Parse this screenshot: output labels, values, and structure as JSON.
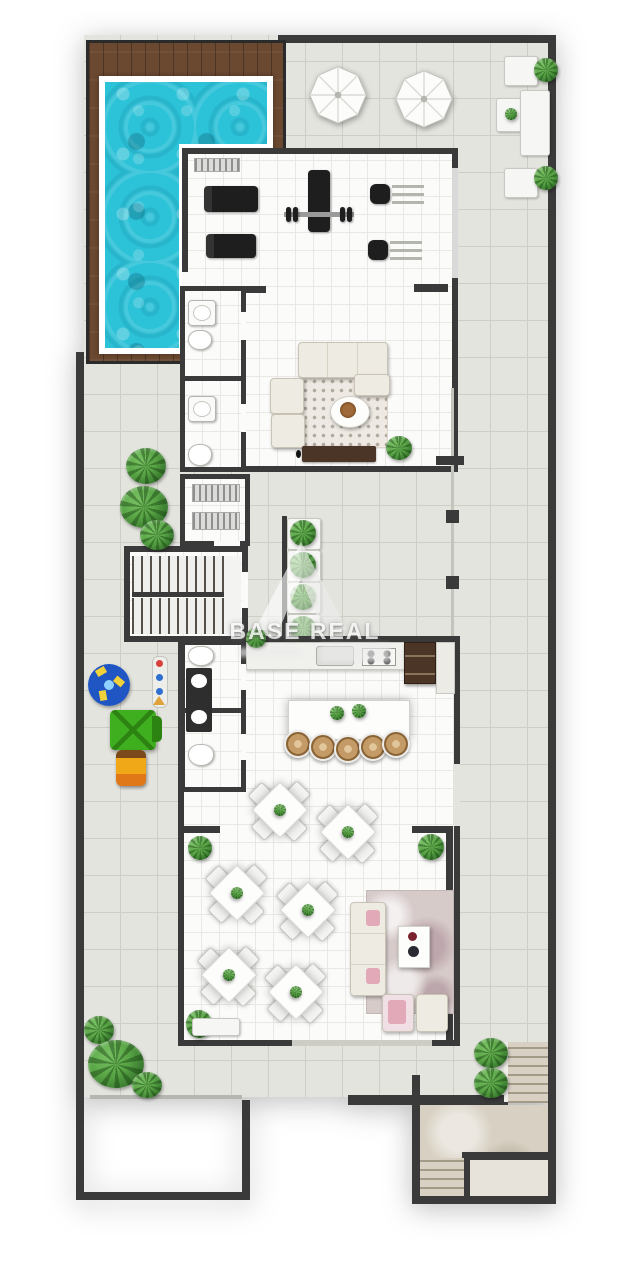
{
  "watermark": {
    "brand": "BASE REAL"
  },
  "colors": {
    "wall": "#3a3a3a",
    "deckA": "#6b4830",
    "deckB": "#54351f",
    "water": "#2cc2d8",
    "waterHi": "#7fe2ef",
    "terrace": "#e4e4df",
    "terraceLine": "#cecec6",
    "indoor": "#fbfbfa",
    "indoorLine": "#e8e8e4",
    "frame": "#ffffff",
    "plantA": "#57a344",
    "plantB": "#2f6b28",
    "equip": "#1e1e1e",
    "woodDark": "#4a3526",
    "stool": "#c49a66",
    "marbleA": "#d7cbca",
    "pinkA": "#e2a9b8",
    "trav": "#d8d1c3",
    "travLine": "#a39a87",
    "glass": "#c4c4bd"
  }
}
